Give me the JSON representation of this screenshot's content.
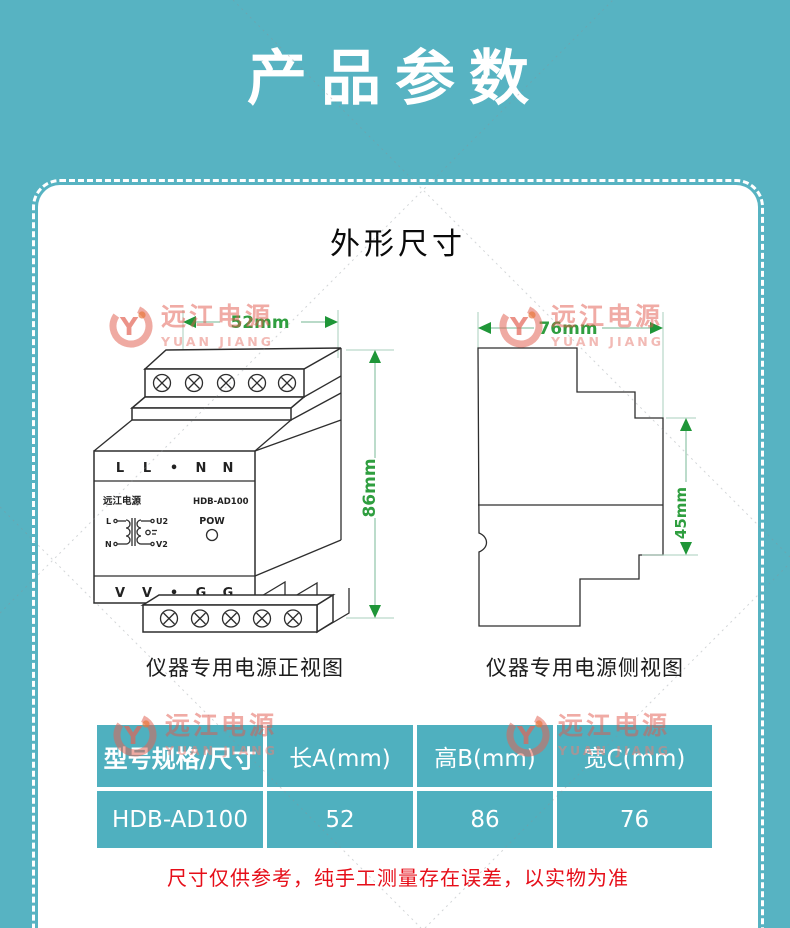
{
  "page": {
    "title": "产品参数",
    "bg_color": "#57b3c2",
    "accent_green": "#2f9e3f",
    "note_color": "#e60e19",
    "table_cell_color": "#4fb0bf",
    "logo_color": "#e2574b"
  },
  "section": {
    "title": "外形尺寸"
  },
  "watermark": {
    "brand_cn": "远江电源",
    "brand_en": "YUAN JIANG",
    "monogram": "Y"
  },
  "front_view": {
    "caption": "仪器专用电源正视图",
    "dim_width": "52mm",
    "dim_height": "86mm",
    "brand": "远江电源",
    "model": "HDB-AD100",
    "pow_label": "POW",
    "top_terminals": [
      "L",
      "L",
      "•",
      "N",
      "N"
    ],
    "bottom_terminals": [
      "V",
      "V",
      "•",
      "G",
      "G"
    ],
    "circuit": {
      "in_top": "L",
      "in_bottom": "N",
      "out_top": "U2",
      "out_bottom": "V2"
    }
  },
  "side_view": {
    "caption": "仪器专用电源侧视图",
    "dim_width": "76mm",
    "dim_height": "45mm"
  },
  "table": {
    "headers": [
      "型号规格/尺寸",
      "长A(mm)",
      "高B(mm)",
      "宽C(mm)"
    ],
    "rows": [
      [
        "HDB-AD100",
        "52",
        "86",
        "76"
      ]
    ]
  },
  "note": "尺寸仅供参考，纯手工测量存在误差，以实物为准"
}
